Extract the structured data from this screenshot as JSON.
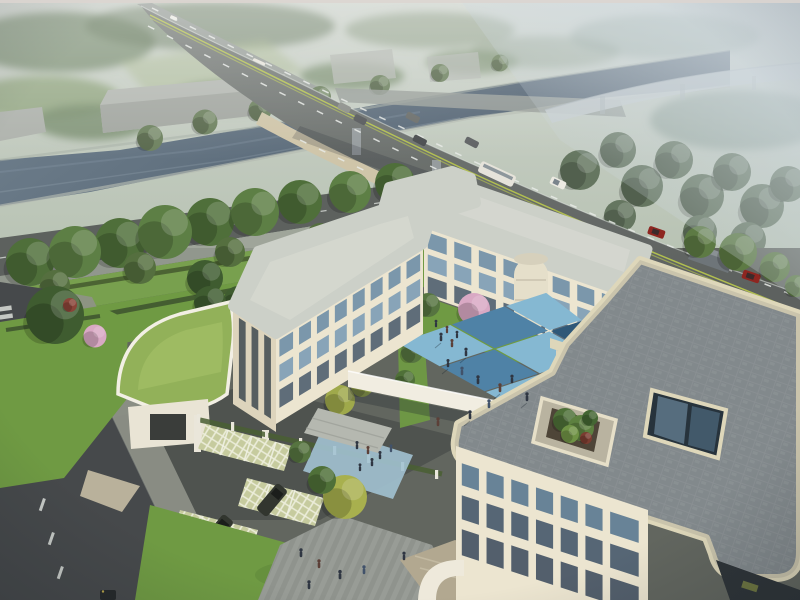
{
  "meta": {
    "type": "architectural-aerial-rendering",
    "subject": "three-storey cream courtyard building campus beside a canal, road bridge and hazy elevated ramp",
    "atmosphere": "hazy daylight"
  },
  "palette": {
    "haze_top": "#cdd3cc",
    "water": "#5b6c7e",
    "asphalt": "#6e7370",
    "frontage_road": "#5d615e",
    "local_road": "#46494b",
    "bridge_fascia": "#cfc5a9",
    "pier": "#969c9e",
    "marking_white": "#e9ece8",
    "marking_green": "#b9c84e",
    "wall_lit": "#ece5d0",
    "wall_mid": "#ddd4bc",
    "wall_shade": "#c8c0a8",
    "roof_light": "#ccd0c8",
    "parapet": "#ded7ba",
    "glass": "#7d9cb5",
    "glass_dark": "#46586a",
    "court_light": "#85b8d2",
    "court_mid": "#4f82a6",
    "court_dark": "#2f5878",
    "court_pale": "#a9ccd9",
    "lawn": "#6f9a43",
    "lawn_band": "#78a04e",
    "green_roof": "#92b159",
    "hedge": "#44592f",
    "tree_green": "#55743c",
    "tree_dark": "#3f5c30",
    "tree_bright": "#5d7a44",
    "tree_yellow": "#a3aa4a",
    "blossom_pink": "#d9a9c4",
    "plaza_gray": "#90948e",
    "path_blue": "#a2c2d2",
    "walkway_white": "#f1ede1",
    "tan_paver": "#b2a890",
    "sidewalk": "#9aa095",
    "suv_dark": "#32362f",
    "car_red": "#8e2620",
    "van_white": "#e9e6df",
    "bus_white": "#e6e3da",
    "person_dark": "#2f3642",
    "warehouse": "#b4b8b2",
    "ramp_haze": "#c6ccce"
  },
  "scene": {
    "water_label": "canal",
    "bridge_label": "road bridge over canal",
    "highway_label": "multi-lane arterial road",
    "ramp_label": "elevated ramp in haze",
    "campus": {
      "left_wing": "3-storey cream wing",
      "north_wing": "3-storey north wing",
      "right_wing": "3-storey wing with roof terrace and atrium lightwell",
      "gatehouse": "curved green-roof gatehouse",
      "walkway": "covered link walkway",
      "courtyard": "blue checkerboard courtyard",
      "parking": "grass-paver parking bays"
    },
    "inventory": {
      "highway_vehicles": 9,
      "far_road_vehicles": 3,
      "street_vehicles": 2,
      "parked_suvs": 2,
      "bottom_edge_car": 1,
      "pedestrians_approx": 27,
      "blossom_trees": 3,
      "warehouses": 5
    }
  }
}
